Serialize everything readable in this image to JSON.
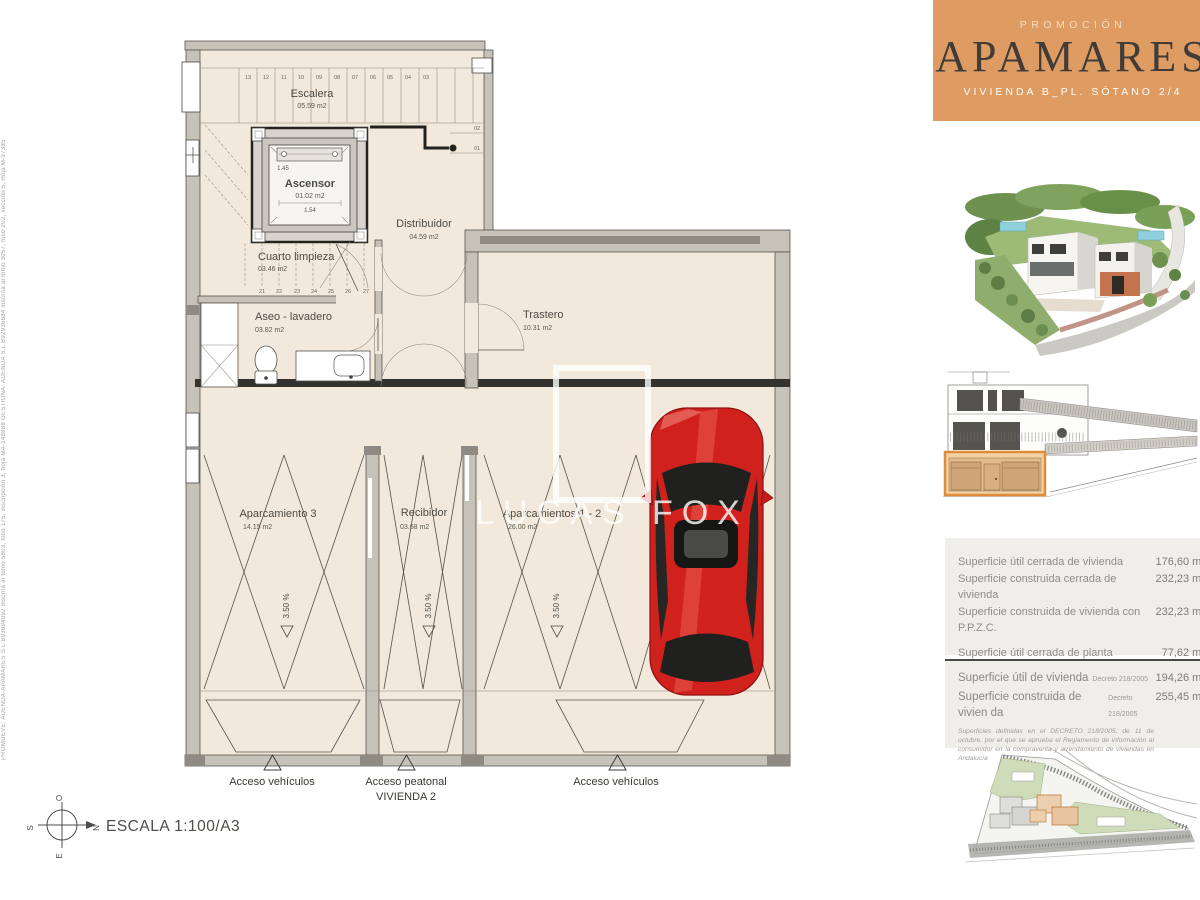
{
  "header": {
    "eyebrow": "PROMOCIÓN",
    "title": "APAMARES",
    "subtitle": "VIVIENDA B_PL. SÓTANO 2/4"
  },
  "side_note": "PROMUEVE: ADENDA-APAMARES S.L B93694092 inscrita al tomo 5803, folio 175, inscripción 3, hoja MA-148888   GESTIONA: ADENDA S.L B92936684 inscrita al tomo 3057, folio 202, sección 5, Hoja M-97385",
  "plan": {
    "rooms": {
      "escalera": {
        "name": "Escalera",
        "area": "05.59 m2"
      },
      "ascensor": {
        "name": "Ascensor",
        "area": "01.02 m2"
      },
      "distribuidor": {
        "name": "Distribuidor",
        "area": "04.59 m2"
      },
      "cuarto": {
        "name": "Cuarto limpieza",
        "area": "03.46 m2"
      },
      "aseo": {
        "name": "Aseo - lavadero",
        "area": "03.82 m2"
      },
      "trastero": {
        "name": "Trastero",
        "area": "10.31 m2"
      },
      "aparcamiento3": {
        "name": "Aparcamiento 3",
        "area": "14.15 m2"
      },
      "recibidor": {
        "name": "Recibidor",
        "area": "03.68 m2"
      },
      "aparcamientos12": {
        "name": "Aparcamientos 1 - 2",
        "area": "26.00 m2"
      }
    },
    "elevator_dims": {
      "width": "1.54",
      "depth": "1.45"
    },
    "slope_label": "3.50 %",
    "stairs": {
      "top": [
        "13",
        "12",
        "11",
        "10",
        "09",
        "08",
        "07",
        "06",
        "05",
        "04",
        "03"
      ],
      "side": [
        "02",
        "01"
      ],
      "bottom": [
        "21",
        "22",
        "23",
        "24",
        "25",
        "26",
        "27"
      ]
    },
    "access": {
      "left": "Acceso vehículos",
      "center": "Acceso peatonal",
      "vivienda": "VIVIENDA 2",
      "right": "Acceso vehículos"
    },
    "scale_label": "ESCALA 1:100/A3",
    "compass": {
      "n": "N",
      "s": "S",
      "e": "E",
      "o": "O"
    }
  },
  "watermark": "LUCAS FOX",
  "colors": {
    "brand_orange": "#de9c63",
    "plan_cream": "#f2e9dc",
    "highlight_orange": "#df8c3a",
    "car_red": "#d0211d"
  },
  "surfaces_block1": {
    "rows": [
      {
        "label": "Superficie útil cerrada de vivienda",
        "value": "176,60 m²"
      },
      {
        "label": "Superficie construida cerrada de vivienda",
        "value": "232,23 m²"
      },
      {
        "label": "Superficie construida de vivienda con P.P.Z.C.",
        "value": "232,23 m²"
      },
      {
        "label": "Superficie útil cerrada de planta",
        "value": "77,62 m²"
      },
      {
        "label": "Superficie const. cerrada de planta",
        "value": "103,19 m²"
      },
      {
        "label": "Superficie exterior",
        "value": "00,00 m²"
      }
    ]
  },
  "surfaces_block2": {
    "rows": [
      {
        "label": "Superficie útil de vivienda",
        "note": "Decreto 218/2005",
        "value": "194,26 m²"
      },
      {
        "label": "Superficie construida de vivien da",
        "note": "Decreto 218/2005",
        "value": "255,45 m²"
      }
    ],
    "disclaimer": "Superficies definidas en el DECRETO 218/2005, de 11 de octubre, por el que se aprueba el Reglamento de información al consumidor en la compraventa y arrendamiento de viviendas en Andalucía"
  }
}
